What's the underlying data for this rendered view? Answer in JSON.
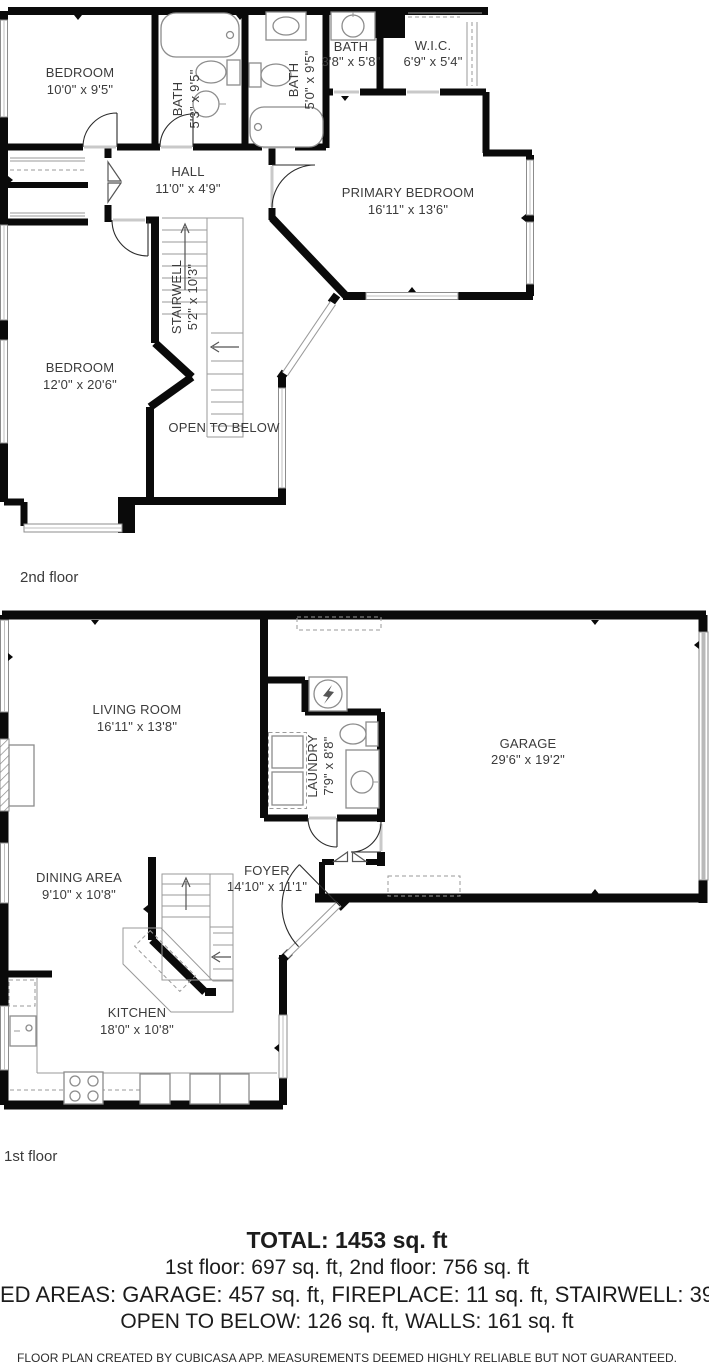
{
  "document": "floor-plan",
  "colors": {
    "wall": "#0a0a0a",
    "fixture_outline": "#8c8c8c",
    "room_label": "#3b3b3b",
    "garage_door": "#b9b9b9",
    "background": "#ffffff"
  },
  "floors": [
    {
      "label": "2nd floor",
      "rooms": [
        {
          "name": "BEDROOM",
          "dims": "10'0\" x 9'5\""
        },
        {
          "name": "BATH",
          "dims": "5'3\" x 9'5\""
        },
        {
          "name": "BATH",
          "dims": "5'0\" x 9'5\""
        },
        {
          "name": "BATH",
          "dims": "3'8\" x 5'8\""
        },
        {
          "name": "W.I.C.",
          "dims": "6'9\" x 5'4\""
        },
        {
          "name": "HALL",
          "dims": "11'0\" x 4'9\""
        },
        {
          "name": "PRIMARY BEDROOM",
          "dims": "16'11\" x 13'6\""
        },
        {
          "name": "STAIRWELL",
          "dims": "5'2\" x 10'3\""
        },
        {
          "name": "BEDROOM",
          "dims": "12'0\" x 20'6\""
        },
        {
          "name": "OPEN TO BELOW",
          "dims": ""
        }
      ]
    },
    {
      "label": "1st floor",
      "rooms": [
        {
          "name": "LIVING ROOM",
          "dims": "16'11\" x 13'8\""
        },
        {
          "name": "LAUNDRY",
          "dims": "7'9\" x 8'8\""
        },
        {
          "name": "GARAGE",
          "dims": "29'6\" x 19'2\""
        },
        {
          "name": "DINING AREA",
          "dims": "9'10\" x 10'8\""
        },
        {
          "name": "FOYER",
          "dims": "14'10\" x 11'1\""
        },
        {
          "name": "KITCHEN",
          "dims": "18'0\" x 10'8\""
        }
      ]
    }
  ],
  "summary": {
    "total": "TOTAL: 1453 sq. ft",
    "floors_line": "1st floor: 697 sq. ft, 2nd floor: 756 sq. ft",
    "excluded_line": "ED AREAS: GARAGE: 457 sq. ft, FIREPLACE: 11 sq. ft, STAIRWELL: 39",
    "open_below_line": "OPEN TO BELOW: 126 sq. ft, WALLS: 161 sq. ft",
    "disclaimer": "FLOOR PLAN CREATED BY CUBICASA APP. MEASUREMENTS DEEMED HIGHLY RELIABLE BUT NOT GUARANTEED."
  }
}
